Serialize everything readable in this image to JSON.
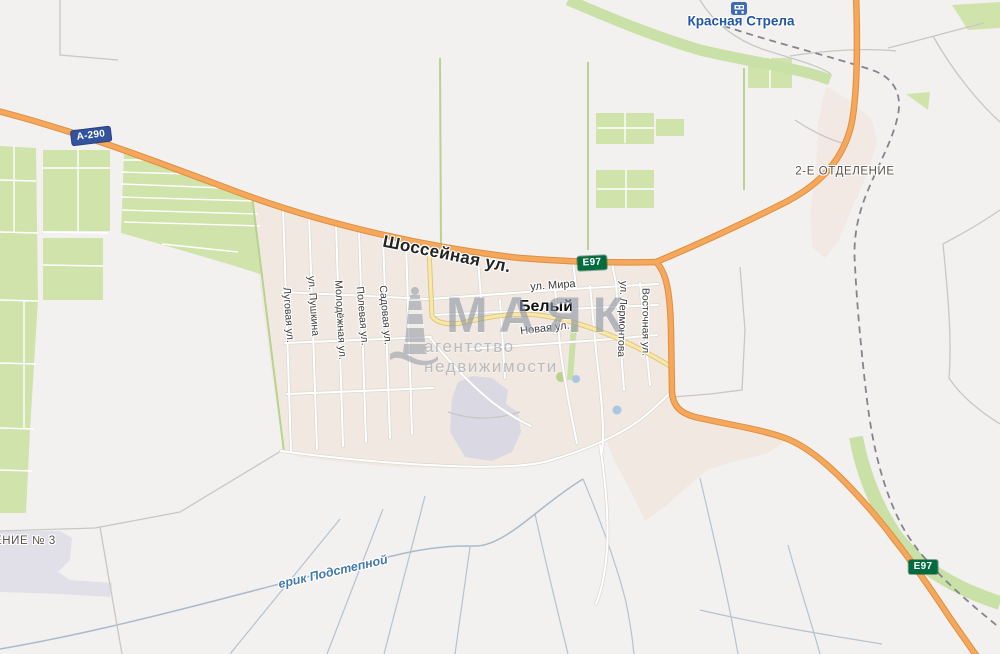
{
  "map": {
    "town": {
      "bely": "Белый"
    },
    "streets": {
      "shosseynaya": "Шоссейная ул.",
      "mira": "ул. Мира",
      "novaya": "Новая ул.",
      "lugovaya": "Луговая ул.",
      "pushkina": "ул. Пушкина",
      "molodezhnaya": "Молодёжная ул.",
      "polevaya": "Полевая ул.",
      "sadovaya": "Садовая ул.",
      "lermontova": "ул. Лермонтова",
      "vostochnaya": "Восточная ул."
    },
    "road_badges": {
      "a290": "А-290",
      "e97": "Е97"
    },
    "places": {
      "krasnaya_strela": "Красная Стрела",
      "otdelenie2": "2-Е ОТДЕЛЕНИЕ",
      "otdelenie3_partial": "ЕНИЕ № 3"
    },
    "water": {
      "erik": "ерик Подстепной"
    },
    "watermark": {
      "title": "МАЯК",
      "subtitle": "агентство недвижимости"
    },
    "icons": {
      "station": "railway-station",
      "watermark_logo": "lighthouse"
    },
    "colors": {
      "land": "#f2f1ef",
      "urban": "#f1e9e1",
      "fields": "#cfe3ab",
      "highway": "#f5a75b",
      "secondary_road": "#f8e7a6",
      "badge_federal": "#33539f",
      "badge_intl": "#046b41",
      "water_label": "#4279ae",
      "railway": "#85848f"
    }
  }
}
